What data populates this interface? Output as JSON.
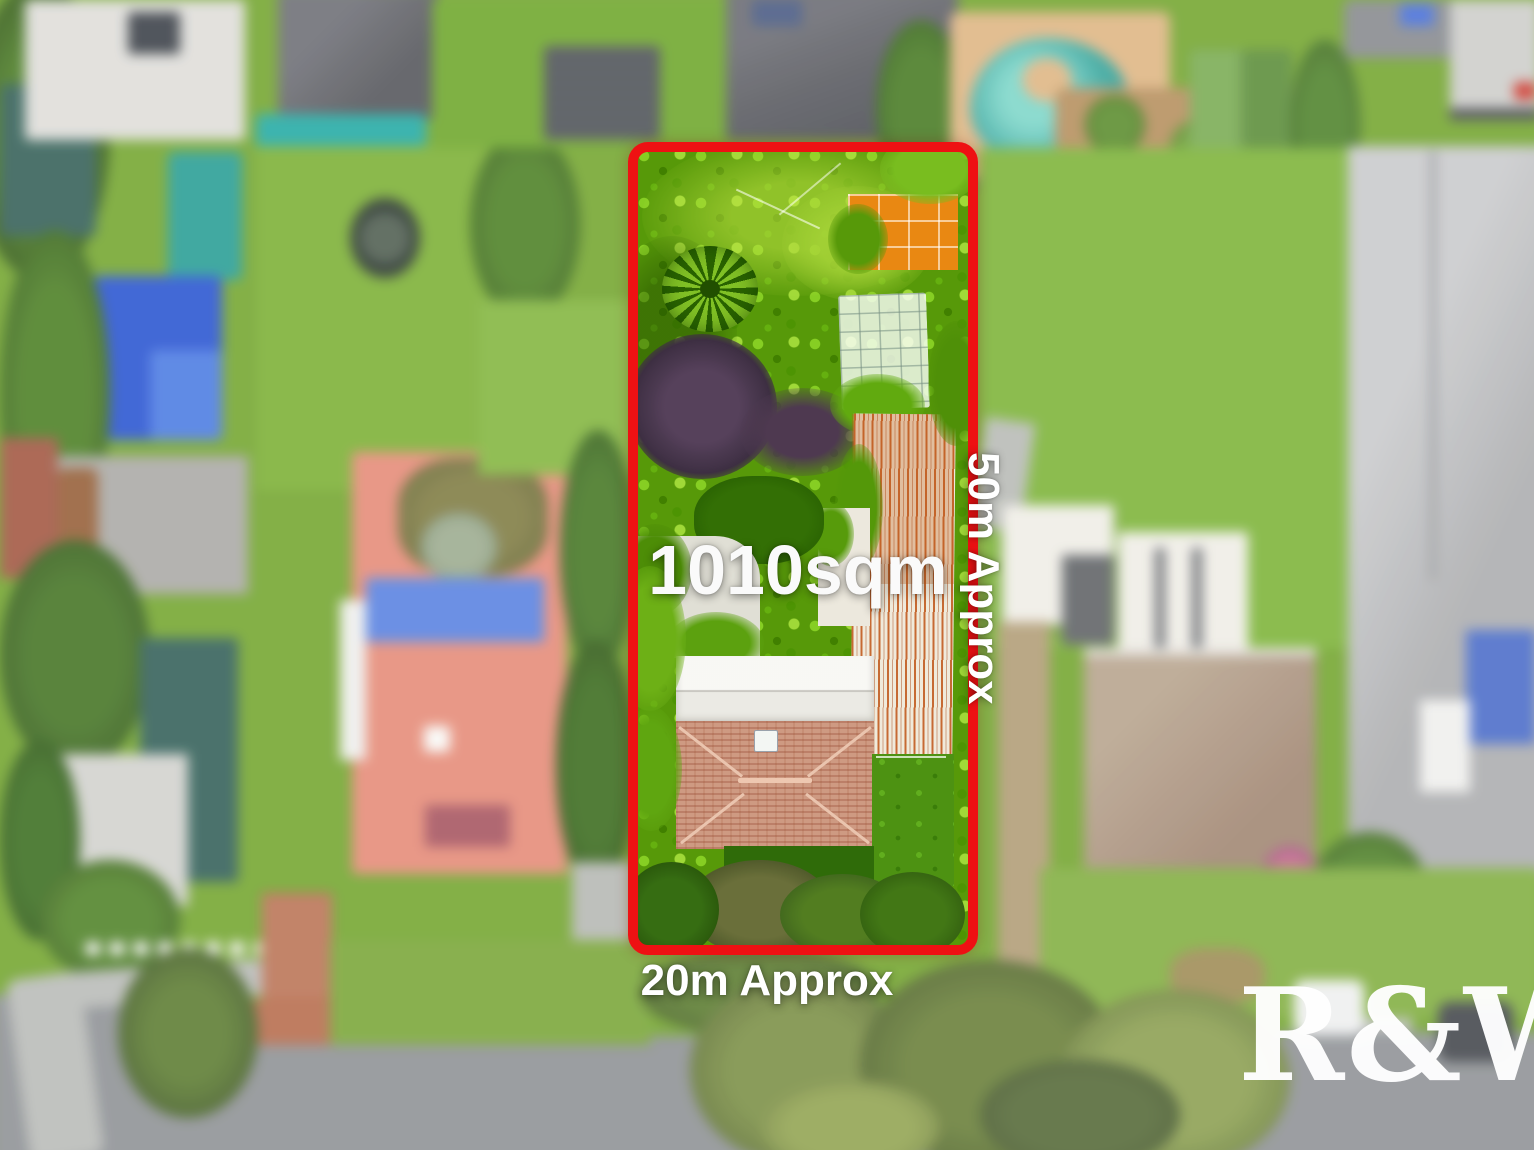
{
  "annotations": {
    "area_label": "1010sqm",
    "depth_label": "50m Approx",
    "frontage_label": "20m Approx",
    "watermark": "R&W"
  },
  "colors": {
    "boundary_red": "#EE1113",
    "label_white": "#FFFFFF",
    "watermark_white": "#FFFFFF"
  },
  "scene_semantics": {
    "subject": "aerial-photo-of-residential-property",
    "highlighted_lot": "long rectangular lot with dense garden, sheds and tile-roof house",
    "surroundings": "blurred neighboring houses, lawns, pool and street"
  }
}
